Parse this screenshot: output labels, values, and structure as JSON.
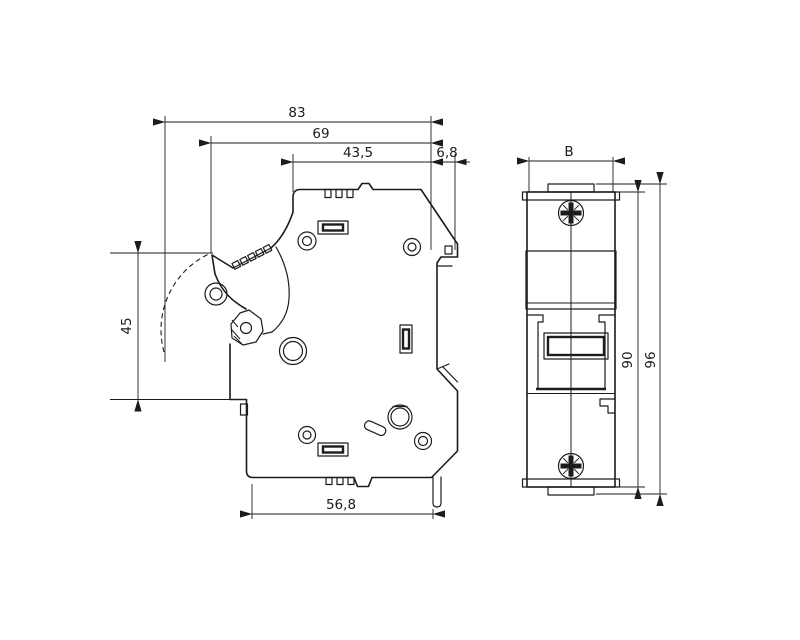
{
  "drawing": {
    "type": "technical-dimension-drawing",
    "subject": "din-rail-fuse-holder",
    "colors": {
      "background": "#ffffff",
      "line": "#1c1c1c"
    },
    "views": {
      "left": "side-view-carrier-open",
      "right": "front-view"
    }
  },
  "dims": {
    "total_width": {
      "label": "83"
    },
    "body_width": {
      "label": "69"
    },
    "upper_width": {
      "label": "43,5"
    },
    "clip_offset": {
      "label": "6,8"
    },
    "handle_height": {
      "label": "45"
    },
    "base_width": {
      "label": "56,8"
    },
    "module_width": {
      "label": "B"
    },
    "body_height": {
      "label": "90"
    },
    "total_height": {
      "label": "96"
    }
  }
}
